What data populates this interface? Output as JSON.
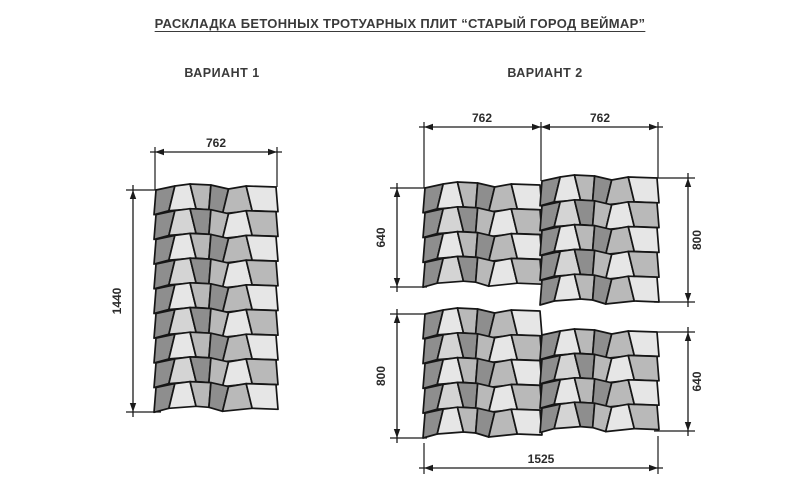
{
  "title": "РАСКЛАДКА БЕТОННЫХ ТРОТУАРНЫХ ПЛИТ “СТАРЫЙ ГОРОД ВЕЙМАР”",
  "variants": {
    "v1": "ВАРИАНТ 1",
    "v2": "ВАРИАНТ 2"
  },
  "dims": {
    "v1_width": "762",
    "v1_height": "1440",
    "v2_width_left": "762",
    "v2_width_right": "762",
    "v2_left_top": "640",
    "v2_left_bottom": "800",
    "v2_right_top": "800",
    "v2_right_bottom": "640",
    "v2_total_width": "1525"
  },
  "palette": {
    "dark": "#8e8e8e",
    "medium": "#b9b9b9",
    "light": "#e6e6e6",
    "light2": "#d4d4d4",
    "outline": "#161616"
  },
  "blocks": [
    {
      "id": "v1-block",
      "x": 155,
      "y": 184,
      "w": 122,
      "rows": 9,
      "rowH": 24.7
    },
    {
      "id": "v2-top-left",
      "x": 424,
      "y": 182,
      "w": 117,
      "rows": 4,
      "rowH": 24.8
    },
    {
      "id": "v2-top-right",
      "x": 541,
      "y": 175,
      "w": 117,
      "rows": 5,
      "rowH": 24.8
    },
    {
      "id": "v2-bottom-left",
      "x": 424,
      "y": 308,
      "w": 117,
      "rows": 5,
      "rowH": 24.8
    },
    {
      "id": "v2-bottom-right",
      "x": 541,
      "y": 329,
      "w": 117,
      "rows": 4,
      "rowH": 24.4
    }
  ]
}
